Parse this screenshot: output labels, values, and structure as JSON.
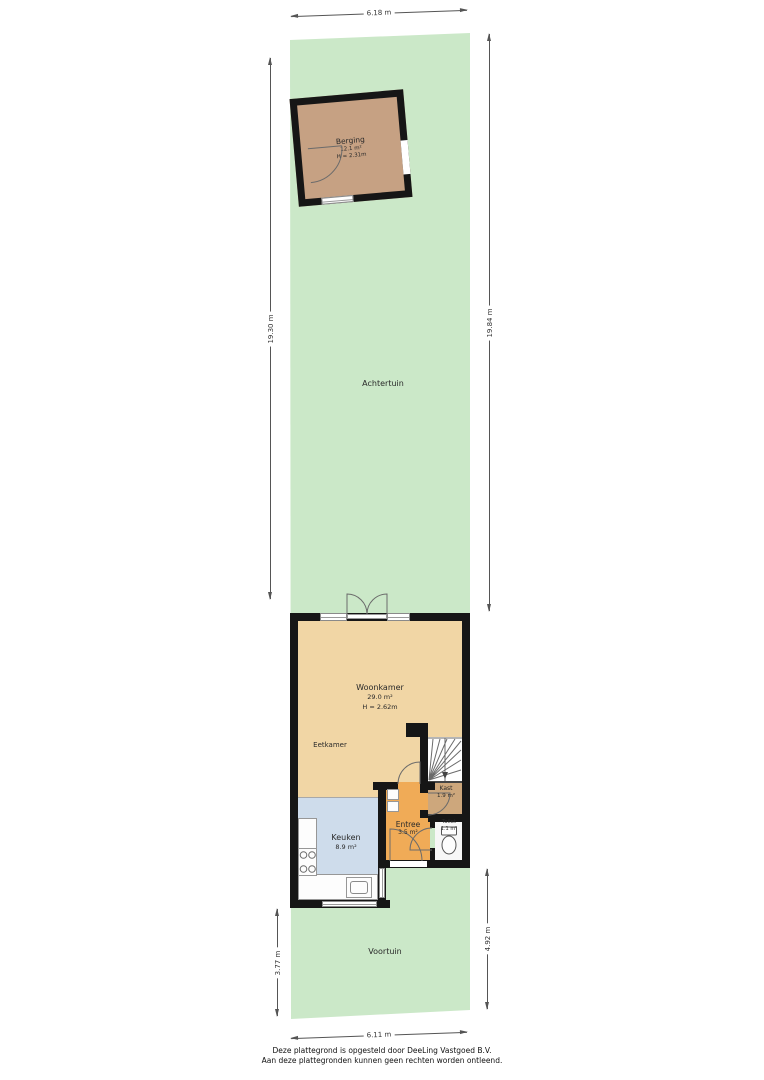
{
  "document": {
    "type": "floor-plan"
  },
  "colors": {
    "garden": "#cbe8c8",
    "berging_floor": "#c6a183",
    "woonkamer_floor": "#f1d6a5",
    "keuken_floor": "#cedceb",
    "entree_floor": "#f0ab57",
    "kast_floor": "#cda77c",
    "toilet_floor": "#f7f7f7",
    "wall": "#161616",
    "dim_line": "#555555"
  },
  "dimensions": {
    "top": "6.18 m",
    "left_upper": "19.30 m",
    "right_upper": "19.84 m",
    "left_lower": "3.77 m",
    "right_lower": "4.92 m",
    "bottom": "6.11 m"
  },
  "rooms": {
    "achtertuin": {
      "name": "Achtertuin"
    },
    "berging": {
      "name": "Berging",
      "area": "12.1 m²",
      "height": "H = 2.31m"
    },
    "woonkamer": {
      "name": "Woonkamer",
      "area": "29.0 m²",
      "height": "H = 2.62m"
    },
    "eetkamer": {
      "name": "Eetkamer"
    },
    "keuken": {
      "name": "Keuken",
      "area": "8.9 m²"
    },
    "entree": {
      "name": "Entree",
      "area": "3.5 m²"
    },
    "kast": {
      "name": "Kast",
      "area": "1.9 m²"
    },
    "toilet": {
      "name": "Toilet",
      "area": "1.1 m²"
    },
    "voortuin": {
      "name": "Voortuin"
    }
  },
  "icons": {
    "stairs": "stairs-down-icon",
    "stove": "stove-4-burner-icon",
    "sink": "kitchen-sink-icon",
    "toilet": "toilet-bowl-icon",
    "door": "door-swing-arc-icon",
    "window": "window-strip-icon"
  },
  "footer": {
    "line1": "Deze plattegrond is opgesteld door DeeLing Vastgoed B.V.",
    "line2": "Aan deze plattegronden kunnen geen rechten worden ontleend."
  }
}
